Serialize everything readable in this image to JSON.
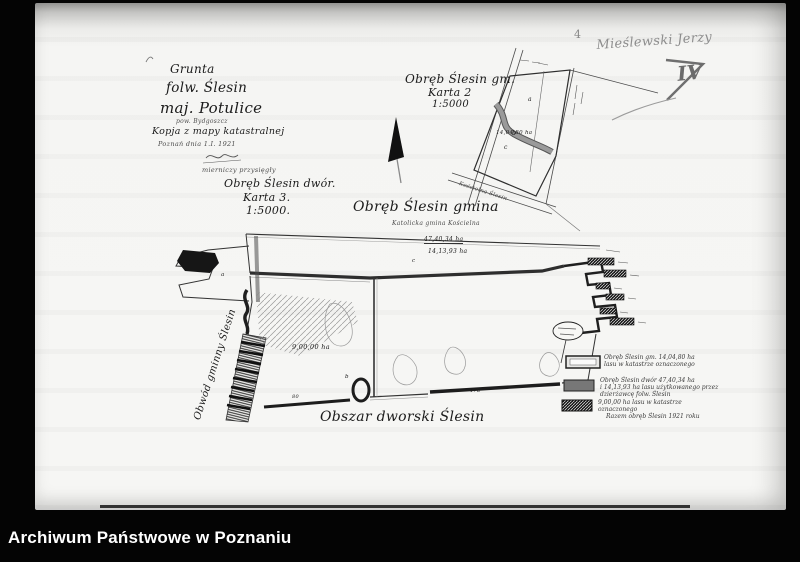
{
  "archive_bar": {
    "label": "Archiwum Państwowe w Poznaniu"
  },
  "pencil": {
    "number": "4",
    "name": "Mieślewski Jerzy",
    "roman": "IV"
  },
  "title_block": {
    "l1": "Grunta",
    "l2": "folw. Ślesin",
    "l3": "maj. Potulice",
    "l4": "pow. Bydgoszcz",
    "l5": "Kopja z mapy katastralnej",
    "l6": "Poznań dnia 1.I. 1921",
    "l7": "mierniczy przysięgły",
    "l8": "Obręb Ślesin dwór.",
    "l9": "Karta 3.",
    "l10": "1:5000."
  },
  "inset_map": {
    "title": "Obręb Ślesin gm.",
    "karta": "Karta 2",
    "scale": "1:5000",
    "area": "14,04,80 ha",
    "road": "Kościelna Ślesin",
    "pa": "a",
    "pb": "b",
    "pc": "c"
  },
  "main_map": {
    "label_gmina": "Obręb Ślesin gmina",
    "label_koscielna": "Katolicka gmina Kościelna",
    "area_1": "47,40,34 ha",
    "area_2": "14,13,93 ha",
    "area_3": "9,00,00 ha",
    "label_dworski": "Obszar dworski Ślesin",
    "label_obwod": "Obwód gminny Ślesin",
    "pa": "a",
    "pb": "b",
    "pc": "c",
    "n80": "80",
    "n17a": "17a"
  },
  "legend": {
    "rows": [
      {
        "l1": "Obręb Ślesin gm. 14,04,80 ha",
        "l2": "lasu w katastrze oznaczonego",
        "l3": ""
      },
      {
        "l1": "Obręb Ślesin dwór 47,40,34 ha",
        "l2": "i 14,13,93 ha lasu użytkowanego przez",
        "l3": "dzierżawcę folw. Ślesin"
      },
      {
        "l1": "9,00,00 ha lasu w katastrze",
        "l2": "oznaczonego",
        "l3": "Razem obręb Ślesin 1921 roku"
      }
    ]
  },
  "colors": {
    "film": "#040404",
    "paper": "#f5f5f3",
    "ink": "#1f1f1f",
    "pencil": "#878787"
  }
}
